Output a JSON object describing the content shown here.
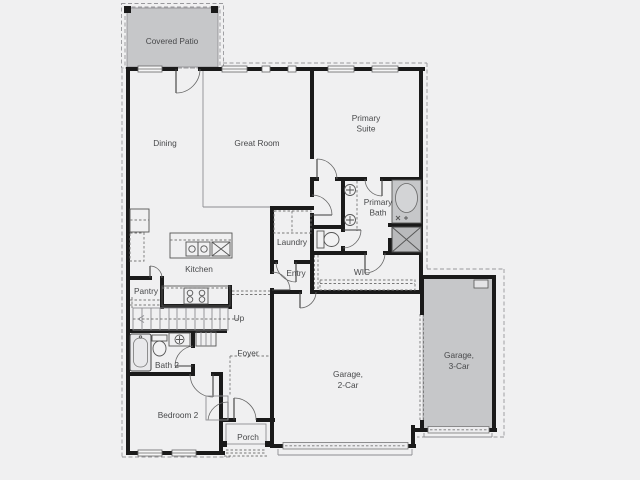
{
  "title": "Single-story floor plan",
  "colors": {
    "background": "#f0f0f1",
    "patio_fill": "#c6c7c9",
    "garage_fill": "#c6c7c9",
    "shower_fill": "#b9babc",
    "wall": "#1a1a1a",
    "thin_line": "#8d8d91",
    "label_text": "#47484a"
  },
  "rooms": {
    "covered_patio": {
      "label": "Covered Patio"
    },
    "dining": {
      "label": "Dining"
    },
    "great_room": {
      "label": "Great Room"
    },
    "primary_suite": {
      "line1": "Primary",
      "line2": "Suite"
    },
    "primary_bath": {
      "line1": "Primary",
      "line2": "Bath"
    },
    "laundry": {
      "label": "Laundry"
    },
    "kitchen": {
      "label": "Kitchen"
    },
    "pantry": {
      "label": "Pantry"
    },
    "entry": {
      "label": "Entry"
    },
    "wic": {
      "label": "WIC"
    },
    "stairs": {
      "label": "Up"
    },
    "foyer": {
      "label": "Foyer"
    },
    "bath_2": {
      "label": "Bath 2"
    },
    "bedroom_2": {
      "label": "Bedroom 2"
    },
    "porch": {
      "label": "Porch"
    },
    "garage_2_car": {
      "line1": "Garage,",
      "line2": "2-Car"
    },
    "garage_3_car": {
      "line1": "Garage,",
      "line2": "3-Car"
    }
  },
  "fixtures": [
    "kitchen-island-sink",
    "dishwasher",
    "range",
    "pantry-shelves",
    "washer-dryer",
    "bathtub",
    "shower",
    "toilet",
    "double-vanity-sinks",
    "tub-bath-2",
    "linen-shelves",
    "stairs-up",
    "closet-shelf",
    "water-heater",
    "garage-door",
    "porch-steps",
    "windows",
    "door-swings"
  ]
}
